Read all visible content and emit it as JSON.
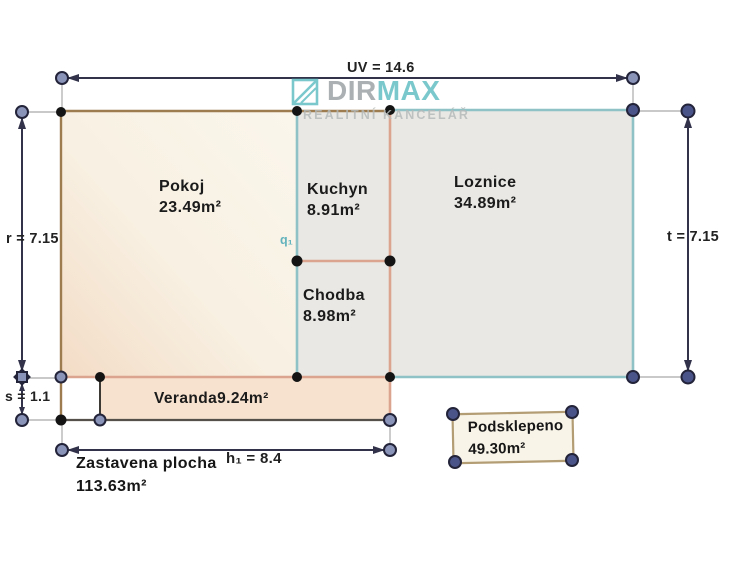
{
  "brand": {
    "dir": "DIR",
    "max": "MAX",
    "tagline": "REALITNÍ KANCELÁŘ",
    "icon": "dirmax-skylight-icon"
  },
  "rooms": {
    "pokoj": {
      "name": "Pokoj",
      "area": "23.49m²"
    },
    "kuchyn": {
      "name": "Kuchyn",
      "area": "8.91m²"
    },
    "loznice": {
      "name": "Loznice",
      "area": "34.89m²"
    },
    "chodba": {
      "name": "Chodba",
      "area": "8.98m²"
    },
    "veranda": {
      "name": "Veranda",
      "area": "9.24m²"
    },
    "podsklepeno": {
      "name": "Podsklepeno",
      "area": "49.30m²"
    }
  },
  "summary": {
    "label": "Zastavena plocha",
    "area": "113.63m²"
  },
  "dimensions": {
    "top": "UV = 14.6",
    "left": "r = 7.15",
    "right": "t = 7.15",
    "left_lower": "s = 1.1",
    "bottom": "h₁ = 8.4",
    "partition": "q₁"
  },
  "colors": {
    "teal_wall": "#8fc2c6",
    "salmon_wall": "#dba48e",
    "brown_wall": "#9d7c4f",
    "dark_wall": "#55504a",
    "dimension_line": "#32324a",
    "marker_slate": "#8a93b8",
    "marker_navy": "#4a5488",
    "brand_teal": "#5fbdc1",
    "brand_gray": "#99a1a3",
    "room_fill_gray": "#e9e8e4",
    "room_fill_cream": "#faf5eb",
    "room_fill_peach": "#f3dcc6"
  }
}
